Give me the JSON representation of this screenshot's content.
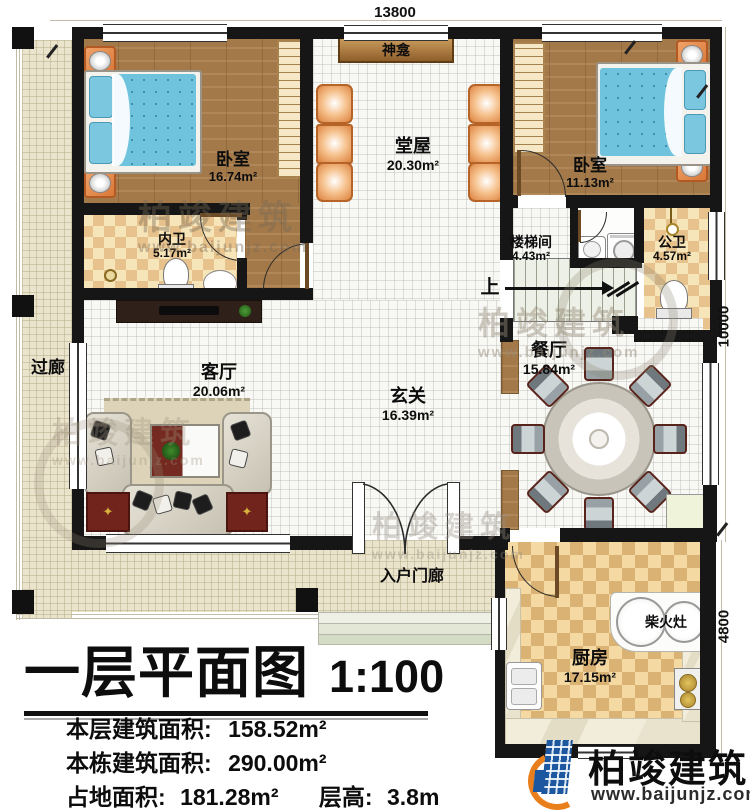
{
  "rooms": {
    "bedroom_left": {
      "label": "卧室",
      "area": "16.74m²"
    },
    "bedroom_right": {
      "label": "卧室",
      "area": "11.13m²"
    },
    "hall": {
      "label": "堂屋",
      "area": "20.30m²"
    },
    "shrine": {
      "label": "神龛"
    },
    "inner_bath": {
      "label": "内卫",
      "area": "5.17m²"
    },
    "stairwell": {
      "label": "楼梯间",
      "area": "4.43m²"
    },
    "public_bath": {
      "label": "公卫",
      "area": "4.57m²"
    },
    "corridor": {
      "label": "过廊"
    },
    "living": {
      "label": "客厅",
      "area": "20.06m²"
    },
    "foyer": {
      "label": "玄关",
      "area": "16.39m²"
    },
    "dining": {
      "label": "餐厅",
      "area": "15.84m²"
    },
    "entry_porch": {
      "label": "入户门廊"
    },
    "kitchen": {
      "label": "厨房",
      "area": "17.15m²"
    },
    "wood_stove": {
      "label": "柴火灶"
    },
    "stairs_direction": {
      "label": "上"
    }
  },
  "dimensions": {
    "top": "13800",
    "right_upper": "10000",
    "right_lower": "4800"
  },
  "title_block": {
    "title": "一层平面图",
    "scale": "1:100",
    "lines": [
      {
        "label": "本层建筑面积:",
        "value": "158.52m²"
      },
      {
        "label": "本栋建筑面积:",
        "value": "290.00m²"
      },
      {
        "label": "占地面积:",
        "value": "181.28m²"
      },
      {
        "label": "层高:",
        "value": "3.8m"
      }
    ]
  },
  "branding": {
    "name": "柏竣建筑",
    "url": "www.baijunjz.com"
  },
  "watermark": {
    "name": "柏竣建筑",
    "url": "www.baijunjz.com"
  },
  "colors": {
    "wall": "#161616",
    "wood_floor": "#a4794a",
    "tile": "#f8f8f5",
    "porch": "#ebe4cc",
    "bath_checker": "#e7c28c",
    "kitchen_checker": "#d9b274",
    "bed_blue": "#6fc3dc",
    "chair_orange": "#e08b4a",
    "sofa": "#d6d2c4",
    "accent_red": "#71241b",
    "logo_blue": "#1d57a0",
    "logo_orange": "#e87f1c"
  }
}
